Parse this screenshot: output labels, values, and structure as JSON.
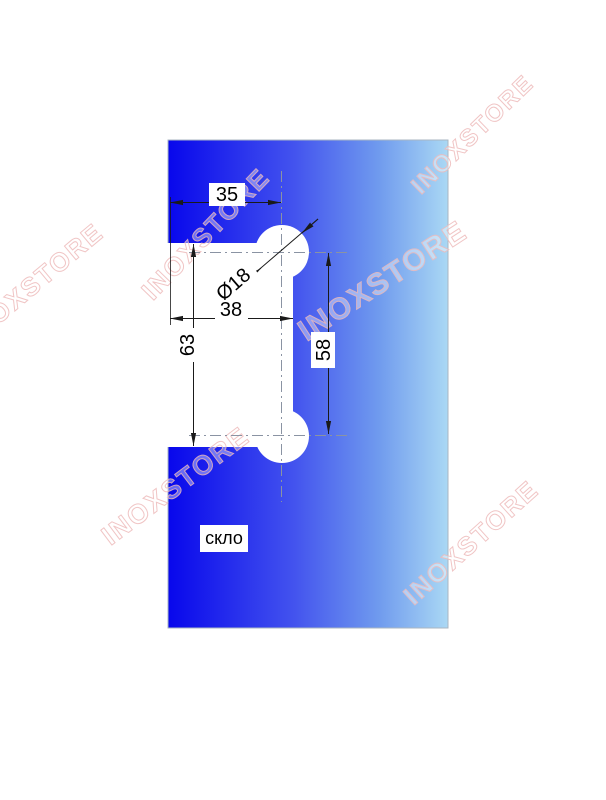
{
  "drawing": {
    "type": "glass-cutout-technical-drawing",
    "material_label": "скло",
    "watermark_text": "INOXSTORE",
    "dimensions": {
      "offset_top": "35",
      "hole_diameter": "Ø18",
      "notch_width": "38",
      "notch_height": "63",
      "hole_spacing": "58"
    },
    "colors": {
      "glass_dark": "#0807ec",
      "glass_mid": "#4353ee",
      "glass_light": "#aad8f4",
      "watermark_pink": "#eebcbc",
      "dimension_line": "#1a1a1a",
      "centerline_gray": "#8a93a3"
    }
  }
}
